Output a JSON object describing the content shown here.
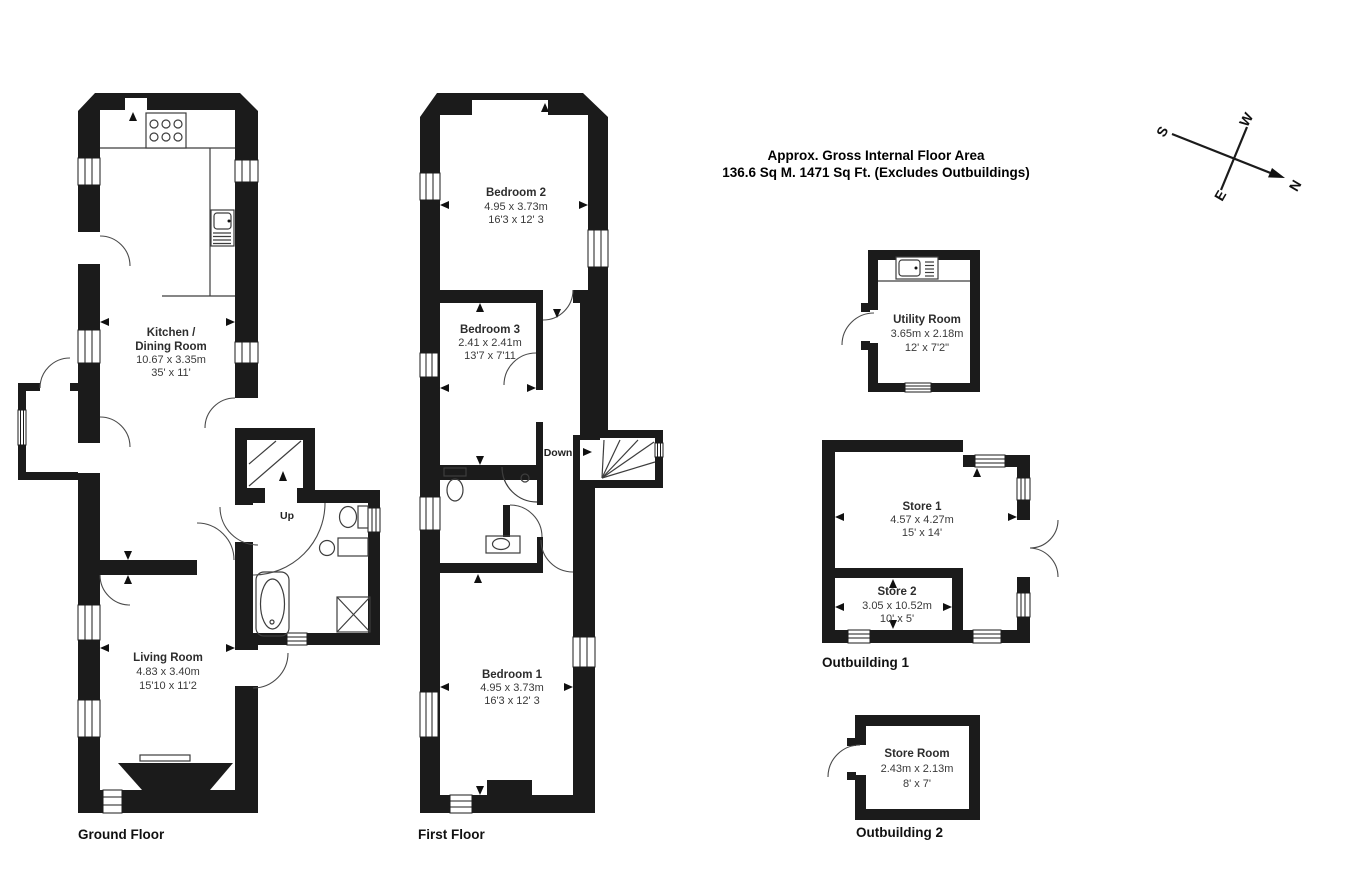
{
  "title": {
    "line1": "Approx. Gross Internal Floor Area",
    "line2": "136.6 Sq M. 1471 Sq Ft. (Excludes Outbuildings)"
  },
  "compass": {
    "north": "N",
    "south": "S",
    "east": "E",
    "west": "W"
  },
  "floors": {
    "ground": {
      "label": "Ground Floor",
      "kitchen": {
        "name1": "Kitchen /",
        "name2": "Dining Room",
        "metric": "10.67 x 3.35m",
        "imperial": "35' x 11'"
      },
      "living": {
        "name": "Living Room",
        "metric": "4.83 x 3.40m",
        "imperial": "15'10 x 11'2"
      },
      "stairs_label": "Up"
    },
    "first": {
      "label": "First Floor",
      "bedroom2": {
        "name": "Bedroom 2",
        "metric": "4.95 x 3.73m",
        "imperial": "16'3 x 12' 3"
      },
      "bedroom3": {
        "name": "Bedroom 3",
        "metric": "2.41 x 2.41m",
        "imperial": "13'7 x 7'11"
      },
      "bedroom1": {
        "name": "Bedroom 1",
        "metric": "4.95 x 3.73m",
        "imperial": "16'3 x 12' 3"
      },
      "stairs_label": "Down"
    }
  },
  "outbuildings": {
    "utility": {
      "name": "Utility Room",
      "metric": "3.65m x 2.18m",
      "imperial": "12' x 7'2\""
    },
    "outbuilding1": {
      "label": "Outbuilding 1",
      "store1": {
        "name": "Store 1",
        "metric": "4.57 x 4.27m",
        "imperial": "15' x 14'"
      },
      "store2": {
        "name": "Store 2",
        "metric": "3.05 x 10.52m",
        "imperial": "10' x 5'"
      }
    },
    "outbuilding2": {
      "label": "Outbuilding 2",
      "store_room": {
        "name": "Store Room",
        "metric": "2.43m x 2.13m",
        "imperial": "8' x 7'"
      }
    }
  }
}
